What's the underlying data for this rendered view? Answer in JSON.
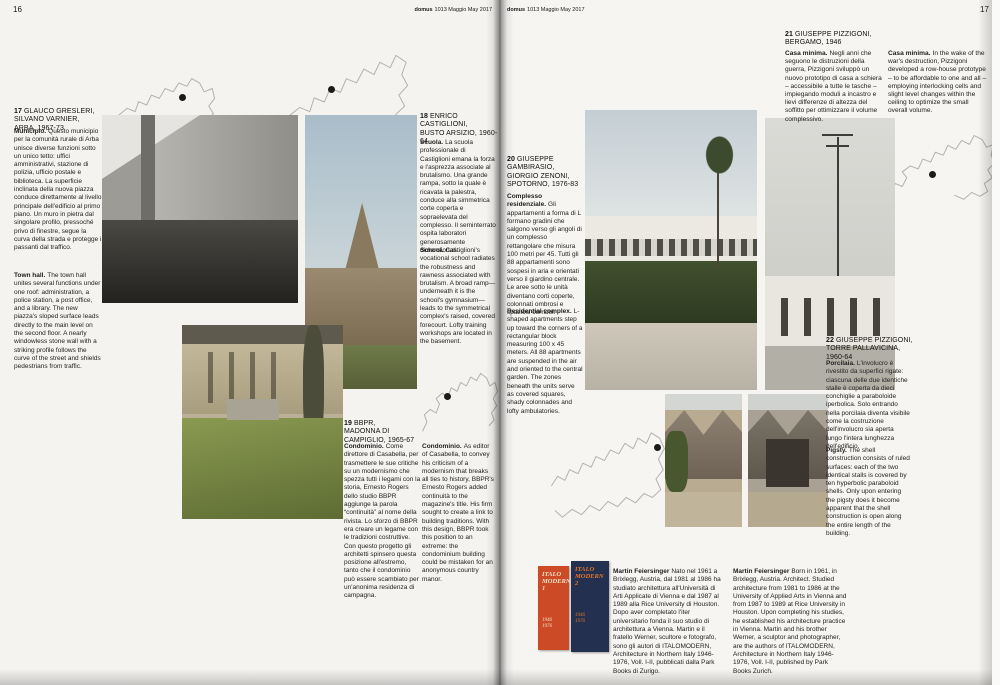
{
  "page": {
    "left_number": "16",
    "right_number": "17",
    "header_brand": "domus",
    "header_issue": "1013 Maggio May 2017"
  },
  "entries": [
    {
      "num": "17",
      "heading": "GLAUCO GRESLERI,\nSILVANO VARNIER,\nARBA, 1967-73",
      "it": {
        "lead": "Municipio.",
        "text": "Questo municipio per la comunità rurale di Arba unisce diverse funzioni sotto un unico tetto: uffici amministrativi, stazione di polizia, ufficio postale e biblioteca. La superficie inclinata della nuova piazza conduce direttamente al livello principale dell'edificio al primo piano. Un muro in pietra dal singolare profilo, pressoché privo di finestre, segue la curva della strada e protegge i passanti dal traffico."
      },
      "en": {
        "lead": "Town hall.",
        "text": "The town hall unites several functions under one roof: administration, a police station, a post office, and a library. The new piazza's sloped surface leads directly to the main level on the second floor. A nearly windowless stone wall with a striking profile follows the curve of the street and shields pedestrians from traffic."
      }
    },
    {
      "num": "18",
      "heading": "ENRICO\nCASTIGLIONI,\nBUSTO ARSIZIO, 1960-64",
      "it": {
        "lead": "Scuola.",
        "text": "La scuola professionale di Castiglioni emana la forza e l'asprezza associate al brutalismo. Una grande rampa, sotto la quale è ricavata la palestra, conduce alla simmetrica corte coperta e sopraelevata del complesso. Il seminterrato ospita laboratori generosamente dimensionati."
      },
      "en": {
        "lead": "School.",
        "text": "Castiglioni's vocational school radiates the robustness and rawness associated with brutalism. A broad ramp—underneath it is the school's gymnasium—leads to the symmetrical complex's raised, covered forecourt. Lofty training workshops are located in the basement."
      }
    },
    {
      "num": "19",
      "heading": "BBPR,\nMADONNA DI\nCAMPIGLIO, 1965-67",
      "it": {
        "lead": "Condominio.",
        "text": "Come direttore di Casabella, per trasmettere le sue critiche su un modernismo che spezza tutti i legami con la storia, Ernesto Rogers dello studio BBPR aggiunge la parola “continuità” al nome della rivista. Lo sforzo di BBPR era creare un legame con le tradizioni costruttive. Con questo progetto gli architetti spinsero questa posizione all'estremo, tanto che il condominio può essere scambiato per un'anonima residenza di campagna."
      },
      "en": {
        "lead": "Condominio.",
        "text": "As editor of Casabella, to convey his criticism of a modernism that breaks all ties to history, BBPR's Ernesto Rogers added continuità to the magazine's title. His firm sought to create a link to building traditions. With this design, BBPR took this position to an extreme: the condominium building could be mistaken for an anonymous country manor."
      }
    },
    {
      "num": "20",
      "heading": "GIUSEPPE\nGAMBIRASIO,\nGIORGIO ZENONI,\nSPOTORNO, 1976-83",
      "it": {
        "lead": "Complesso residenziale.",
        "text": "Gli appartamenti a forma di L formano gradini che salgono verso gli angoli di un complesso rettangolare che misura 100 metri per 45. Tutti gli 88 appartamenti sono sospesi in aria e orientati verso il giardino centrale. Le aree sotto le unità diventano corti coperte, colonnati ombrosi e spaziosi corridoi."
      },
      "en": {
        "lead": "Residential complex.",
        "text": "L-shaped apartments step up toward the corners of a rectangular block measuring 100 x 45 meters. All 88 apartments are suspended in the air and oriented to the central garden. The zones beneath the units serve as covered squares, shady colonnades and lofty ambulatories."
      }
    },
    {
      "num": "21",
      "heading": "GIUSEPPE PIZZIGONI,\nBERGAMO, 1946",
      "it": {
        "lead": "Casa minima.",
        "text": "Negli anni che seguono le distruzioni della guerra, Pizzigoni sviluppò un nuovo prototipo di casa a schiera – accessibile a tutte le tasche – impiegando moduli a incastro e lievi differenze di altezza del soffitto per ottimizzare il volume complessivo."
      },
      "en": {
        "lead": "Casa minima.",
        "text": "In the wake of the war's destruction, Pizzigoni developed a row-house prototype – to be affordable to one and all – employing interlocking cells and slight level changes within the ceiling to optimize the small overall volume."
      }
    },
    {
      "num": "22",
      "heading": "GIUSEPPE PIZZIGONI,\nTORRE PALLAVICINA,\n1960-64",
      "it": {
        "lead": "Porcilaia.",
        "text": "L'involucro è rivestito da superfici rigate: ciascuna delle due identiche stalle è coperta da dieci conchiglie a paraboloide iperbolica. Solo entrando nella porcilaia diventa visibile come la costruzione dell'involucro sia aperta lungo l'intera lunghezza dell'edificio."
      },
      "en": {
        "lead": "Pigsty.",
        "text": "The shell construction consists of ruled surfaces: each of the two identical stalls is covered by ten hyperbolic paraboloid shells. Only upon entering the pigsty does it become apparent that the shell construction is open along the entire length of the building."
      }
    }
  ],
  "bios": {
    "it": {
      "lead": "Martin Feiersinger",
      "text": "Nato nel 1961 a Brixlegg, Austria, dal 1981 al 1986 ha studiato architettura all'Università di Arti Applicate di Vienna e dal 1987 al 1989 alla Rice University di Houston. Dopo aver completato l'iter universitario fonda il suo studio di architettura a Vienna. Martin e il fratello Werner, scultore e fotografo, sono gli autori di ITALOMODERN, Architecture in Northern Italy 1946-1976, Voll. I-II, pubblicati dalla Park Books di Zurigo."
    },
    "en": {
      "lead": "Martin Feiersinger",
      "text": "Born in 1961, in Brixlegg, Austria. Architect. Studied architecture from 1981 to 1986 at the University of Applied Arts in Vienna and from 1987 to 1989 at Rice University in Houston. Upon completing his studies, he established his architecture practice in Vienna. Martin and his brother Werner, a sculptor and photographer, are the authors of ITALOMODERN, Architecture in Northern Italy 1946-1976, Voll. I-II, published by Park Books Zurich."
    }
  },
  "books": [
    {
      "title": "ITALO\nMODERN 1",
      "years": "1946\n1976"
    },
    {
      "title": "ITALO\nMODERN 2",
      "years": "1946\n1976"
    }
  ],
  "colors": {
    "ink": "#222222",
    "paper": "#f5f4f1",
    "map_line": "#b3b2ad",
    "location_dot": "#1b1b1b",
    "book1_bg": "#cc4b26",
    "book1_text": "#f2e3cf",
    "book2_bg": "#24304f",
    "book2_text": "#e5762a"
  }
}
